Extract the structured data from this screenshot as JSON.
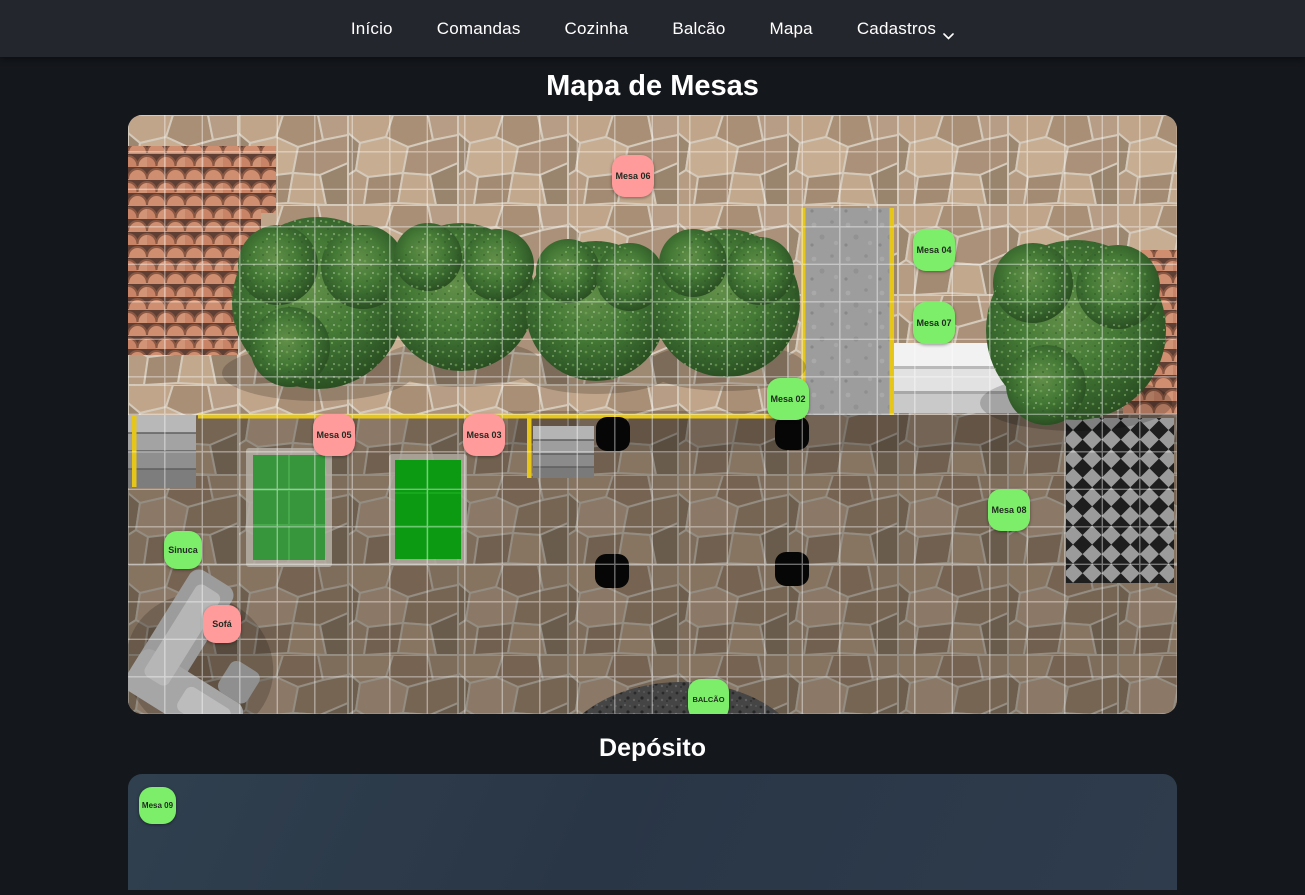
{
  "navbar": {
    "items": [
      {
        "label": "Início"
      },
      {
        "label": "Comandas"
      },
      {
        "label": "Cozinha"
      },
      {
        "label": "Balcão"
      },
      {
        "label": "Mapa"
      },
      {
        "label": "Cadastros"
      }
    ]
  },
  "page": {
    "title": "Mapa de Mesas",
    "deposito_title": "Depósito"
  },
  "colors": {
    "status": {
      "free": "#7dee69",
      "occupied": "#ff9b9b"
    },
    "navbar_bg": "#24262d",
    "page_bg": "#14171c",
    "accent_yellow": "#e5c619",
    "deposito_panel": "#2d3b4c"
  },
  "map": {
    "markers": [
      {
        "label": "Mesa 06",
        "status": "occupied",
        "x": 484,
        "y": 40,
        "w": 42,
        "h": 42,
        "fs": 9
      },
      {
        "label": "Mesa 04",
        "status": "free",
        "x": 785,
        "y": 114,
        "w": 42,
        "h": 42,
        "fs": 9
      },
      {
        "label": "Mesa 07",
        "status": "free",
        "x": 785,
        "y": 187,
        "w": 42,
        "h": 42,
        "fs": 9
      },
      {
        "label": "Mesa 02",
        "status": "free",
        "x": 639,
        "y": 263,
        "w": 42,
        "h": 42,
        "fs": 9
      },
      {
        "label": "Mesa 05",
        "status": "occupied",
        "x": 185,
        "y": 299,
        "w": 42,
        "h": 42,
        "fs": 9
      },
      {
        "label": "Mesa 03",
        "status": "occupied",
        "x": 335,
        "y": 299,
        "w": 42,
        "h": 42,
        "fs": 9
      },
      {
        "label": "Mesa 08",
        "status": "free",
        "x": 860,
        "y": 374,
        "w": 42,
        "h": 42,
        "fs": 9
      },
      {
        "label": "Sinuca",
        "status": "free",
        "x": 36,
        "y": 416,
        "w": 38,
        "h": 38,
        "fs": 9
      },
      {
        "label": "Sofá",
        "status": "occupied",
        "x": 75,
        "y": 490,
        "w": 38,
        "h": 38,
        "fs": 9
      },
      {
        "label": "BALCÃO",
        "status": "free",
        "x": 560,
        "y": 564,
        "w": 41,
        "h": 41,
        "fs": 7.5
      }
    ]
  },
  "deposito": {
    "markers": [
      {
        "label": "Mesa 09",
        "status": "free",
        "x": 11,
        "y": 13,
        "w": 37,
        "h": 37,
        "fs": 8
      }
    ]
  }
}
